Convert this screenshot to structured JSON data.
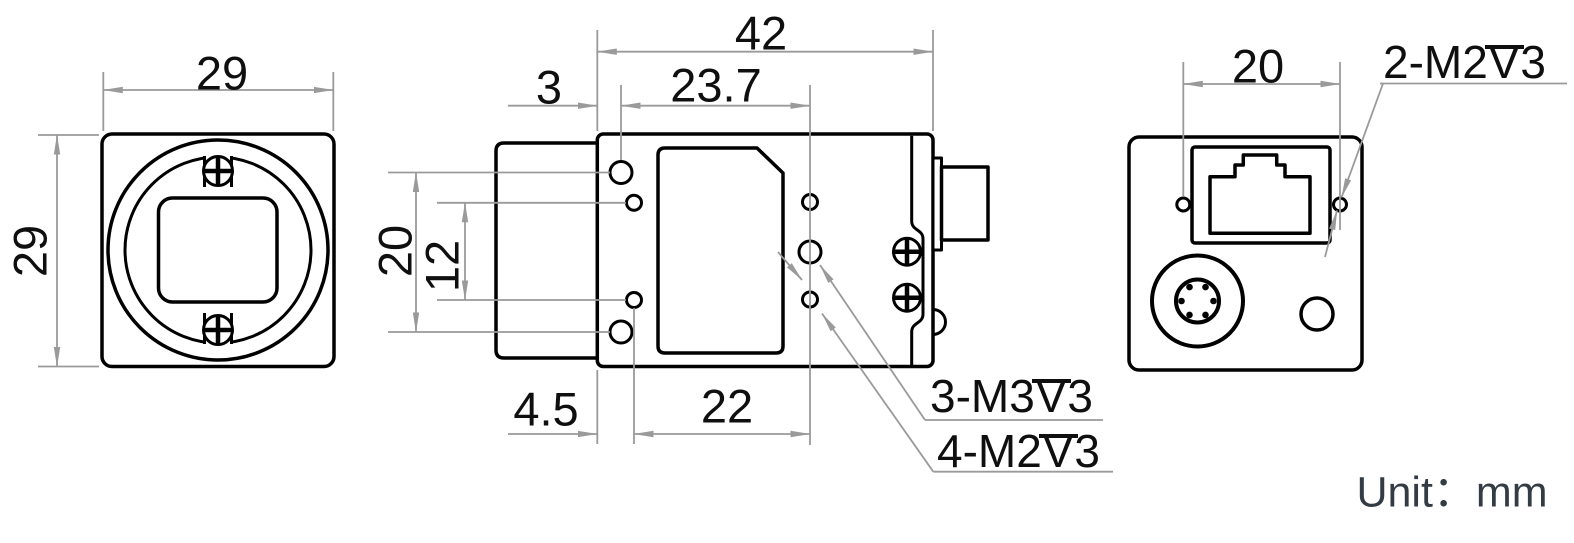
{
  "title": "industrial-camera-dimension-drawing",
  "unit": {
    "text": "Unit：mm"
  },
  "front_view": {
    "dim_width": "29",
    "dim_height": "29"
  },
  "side_view": {
    "dim_body_width": "42",
    "dim_edge_to_m3_holes": "3",
    "dim_m3_hole_span": "23.7",
    "dim_m3_hole_pitch": "20",
    "dim_m2_hole_pitch": "12",
    "dim_edge_to_m2_holes": "4.5",
    "dim_m2_hole_span": "22",
    "label_m3": {
      "prefix": "3-M3",
      "depth_symbol": "V",
      "suffix": "3"
    },
    "label_m2": {
      "prefix": "4-M2",
      "depth_symbol": "V",
      "suffix": "3"
    }
  },
  "back_view": {
    "dim_hole_span": "20",
    "label_m2": {
      "prefix": "2-M2",
      "depth_symbol": "V",
      "suffix": "3"
    }
  },
  "colors": {
    "outline": "#000000",
    "dimension_lines": "#9a9a9a",
    "text": "#0f0f0f",
    "unit_text": "#333b45",
    "background": "#ffffff"
  }
}
